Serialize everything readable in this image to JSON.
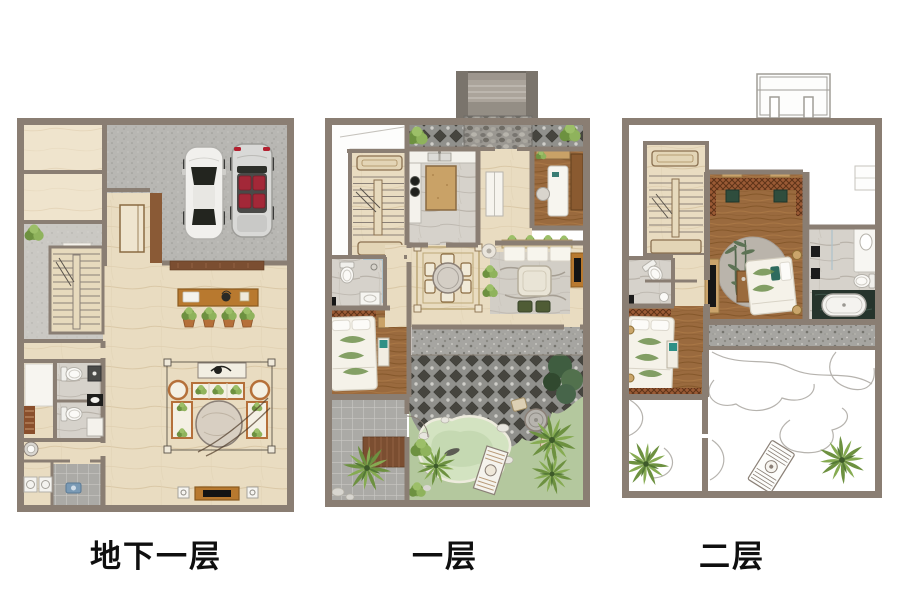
{
  "page": {
    "background_color": "#ffffff",
    "description": "Three-level villa floor plan rendering (basement, first floor, second floor)"
  },
  "floors": [
    {
      "id": "basement",
      "label": "地下一层",
      "features": [
        "storage-room",
        "storage-room",
        "hall-corridor",
        "staircase",
        "elevator",
        "garage",
        "sedan-car",
        "convertible-car",
        "wood-threshold",
        "console-table",
        "potted-plants",
        "sofa-group",
        "round-marble-table",
        "tv-console",
        "speakers",
        "bathroom",
        "bathroom",
        "closet-room",
        "washbasin",
        "laundry-room",
        "washing-machines",
        "shrub"
      ]
    },
    {
      "id": "level1",
      "label": "一层",
      "features": [
        "entry-porch",
        "pebble-path",
        "paved-strip",
        "shrubs",
        "lightwell",
        "staircase",
        "kitchen",
        "island-counter",
        "entry-hall",
        "study",
        "desk",
        "bathroom",
        "toilet",
        "shower",
        "bedroom",
        "double-bed",
        "bench",
        "side-patio",
        "planter-tree",
        "dining-rug",
        "round-dining-table",
        "chairs",
        "living-sofa",
        "coffee-table",
        "ottomans",
        "tv-console",
        "stone-terrace",
        "garden-courtyard",
        "pond",
        "rocks",
        "stone-bridge",
        "stone-table",
        "tropical-trees",
        "bamboo"
      ]
    },
    {
      "id": "level2",
      "label": "二层",
      "features": [
        "porch-railing",
        "staircase",
        "cabinet",
        "hallway",
        "master-bedroom",
        "lattice-frieze",
        "round-carpet",
        "bamboo-motif",
        "double-bed",
        "tv-panel",
        "dresser",
        "gold-lamps",
        "master-bathroom",
        "vanity",
        "toilet",
        "bathtub",
        "shower-doors",
        "bathroom",
        "bedroom",
        "single-bed",
        "bench",
        "balcony",
        "roof-terrace",
        "garden-path-outline",
        "lounge-chair",
        "tropical-plants"
      ]
    }
  ],
  "colors": {
    "wall": "#8a7e73",
    "floor_marble": "#e9dcc1",
    "floor_marble_light": "#efe4cd",
    "concrete": "#b8b7b3",
    "concrete_light": "#cac8c3",
    "wood_floor": "#9a6a3e",
    "gray_marble": "#d6d2cb",
    "dark_paving": "#46453f",
    "pebble": "#9b9892",
    "granite": "#a6a5a1",
    "patio_tile": "#abaaa6",
    "lattice": "#9a5a35",
    "grass": "#b4c89e",
    "pond": "#d3e3c1",
    "foliage": "#7fa24f",
    "sofa_frame": "#b5703a",
    "cabinet_tan": "#c9a267",
    "wood_dark": "#7b4e31",
    "accent_teal": "#2e9086",
    "seat_red": "#a32838",
    "dark_marble": "#26342c",
    "fixture_white": "#f7f6f2",
    "label_text": "#0f0f0f"
  }
}
